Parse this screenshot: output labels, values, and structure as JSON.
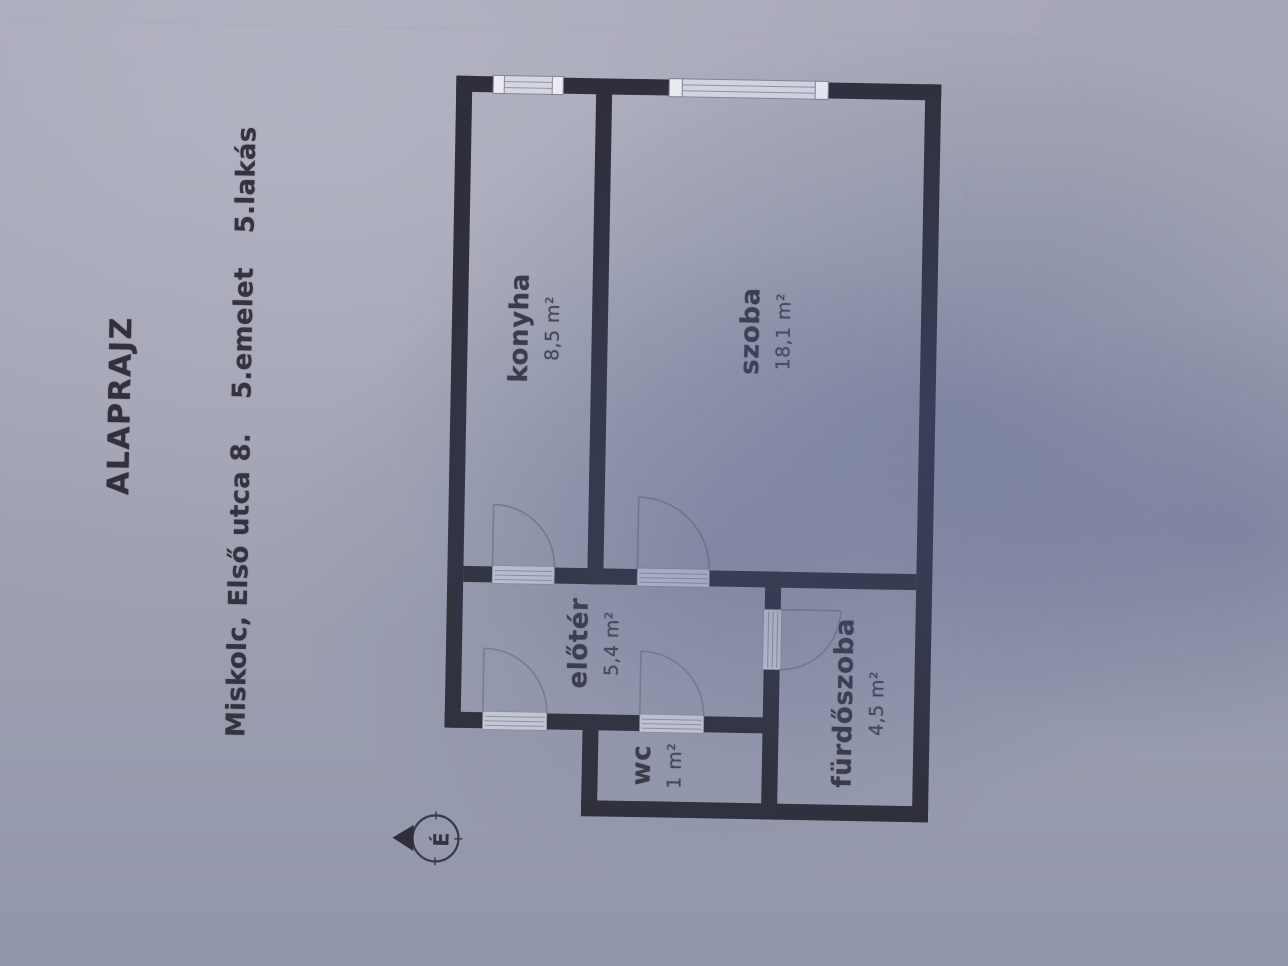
{
  "sheet": {
    "title": "ALAPRAJZ",
    "address": "Miskolc, Első utca 8.",
    "floor": "5.emelet",
    "unit": "5.lakás",
    "north_label": "É"
  },
  "rooms": [
    {
      "name": "konyha",
      "area": "8,5 m²"
    },
    {
      "name": "szoba",
      "area": "18,1 m²"
    },
    {
      "name": "előtér",
      "area": "5,4 m²"
    },
    {
      "name": "wc",
      "area": "1 m²"
    },
    {
      "name": "fürdőszoba",
      "area": "4,5 m²"
    }
  ],
  "colors": {
    "paper": "#a2a4b4",
    "wall": "#2e2f3a",
    "door_line": "#7d8094",
    "threshold": "#ccced9",
    "window": "#d5d7e0",
    "text": "#33343f"
  }
}
